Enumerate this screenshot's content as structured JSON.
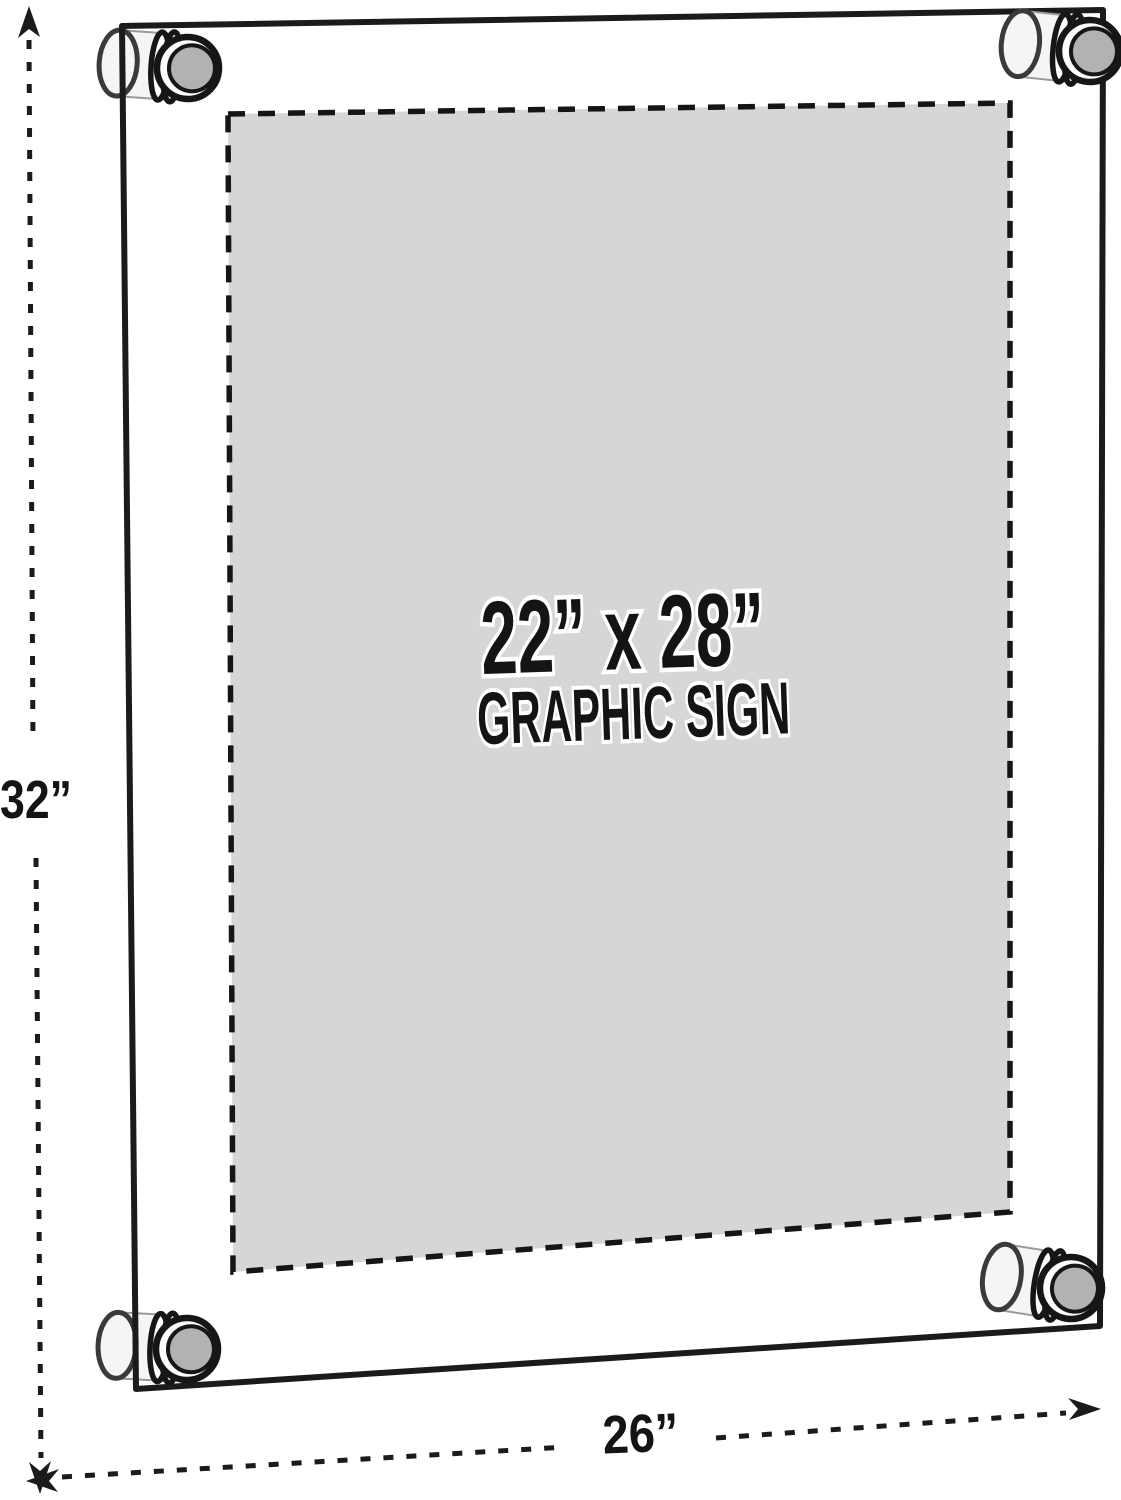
{
  "sign": {
    "size_label": "22” x 28”",
    "type_label": "GRAPHIC SIGN"
  },
  "frame": {
    "height_label": "32”",
    "width_label": "26”"
  },
  "colors": {
    "line": "#1b1b1b",
    "sign_panel": "#d6d6d6",
    "standoff_face": "#b2b2b2",
    "standoff_body": "#f5f5f5",
    "background": "#ffffff"
  }
}
